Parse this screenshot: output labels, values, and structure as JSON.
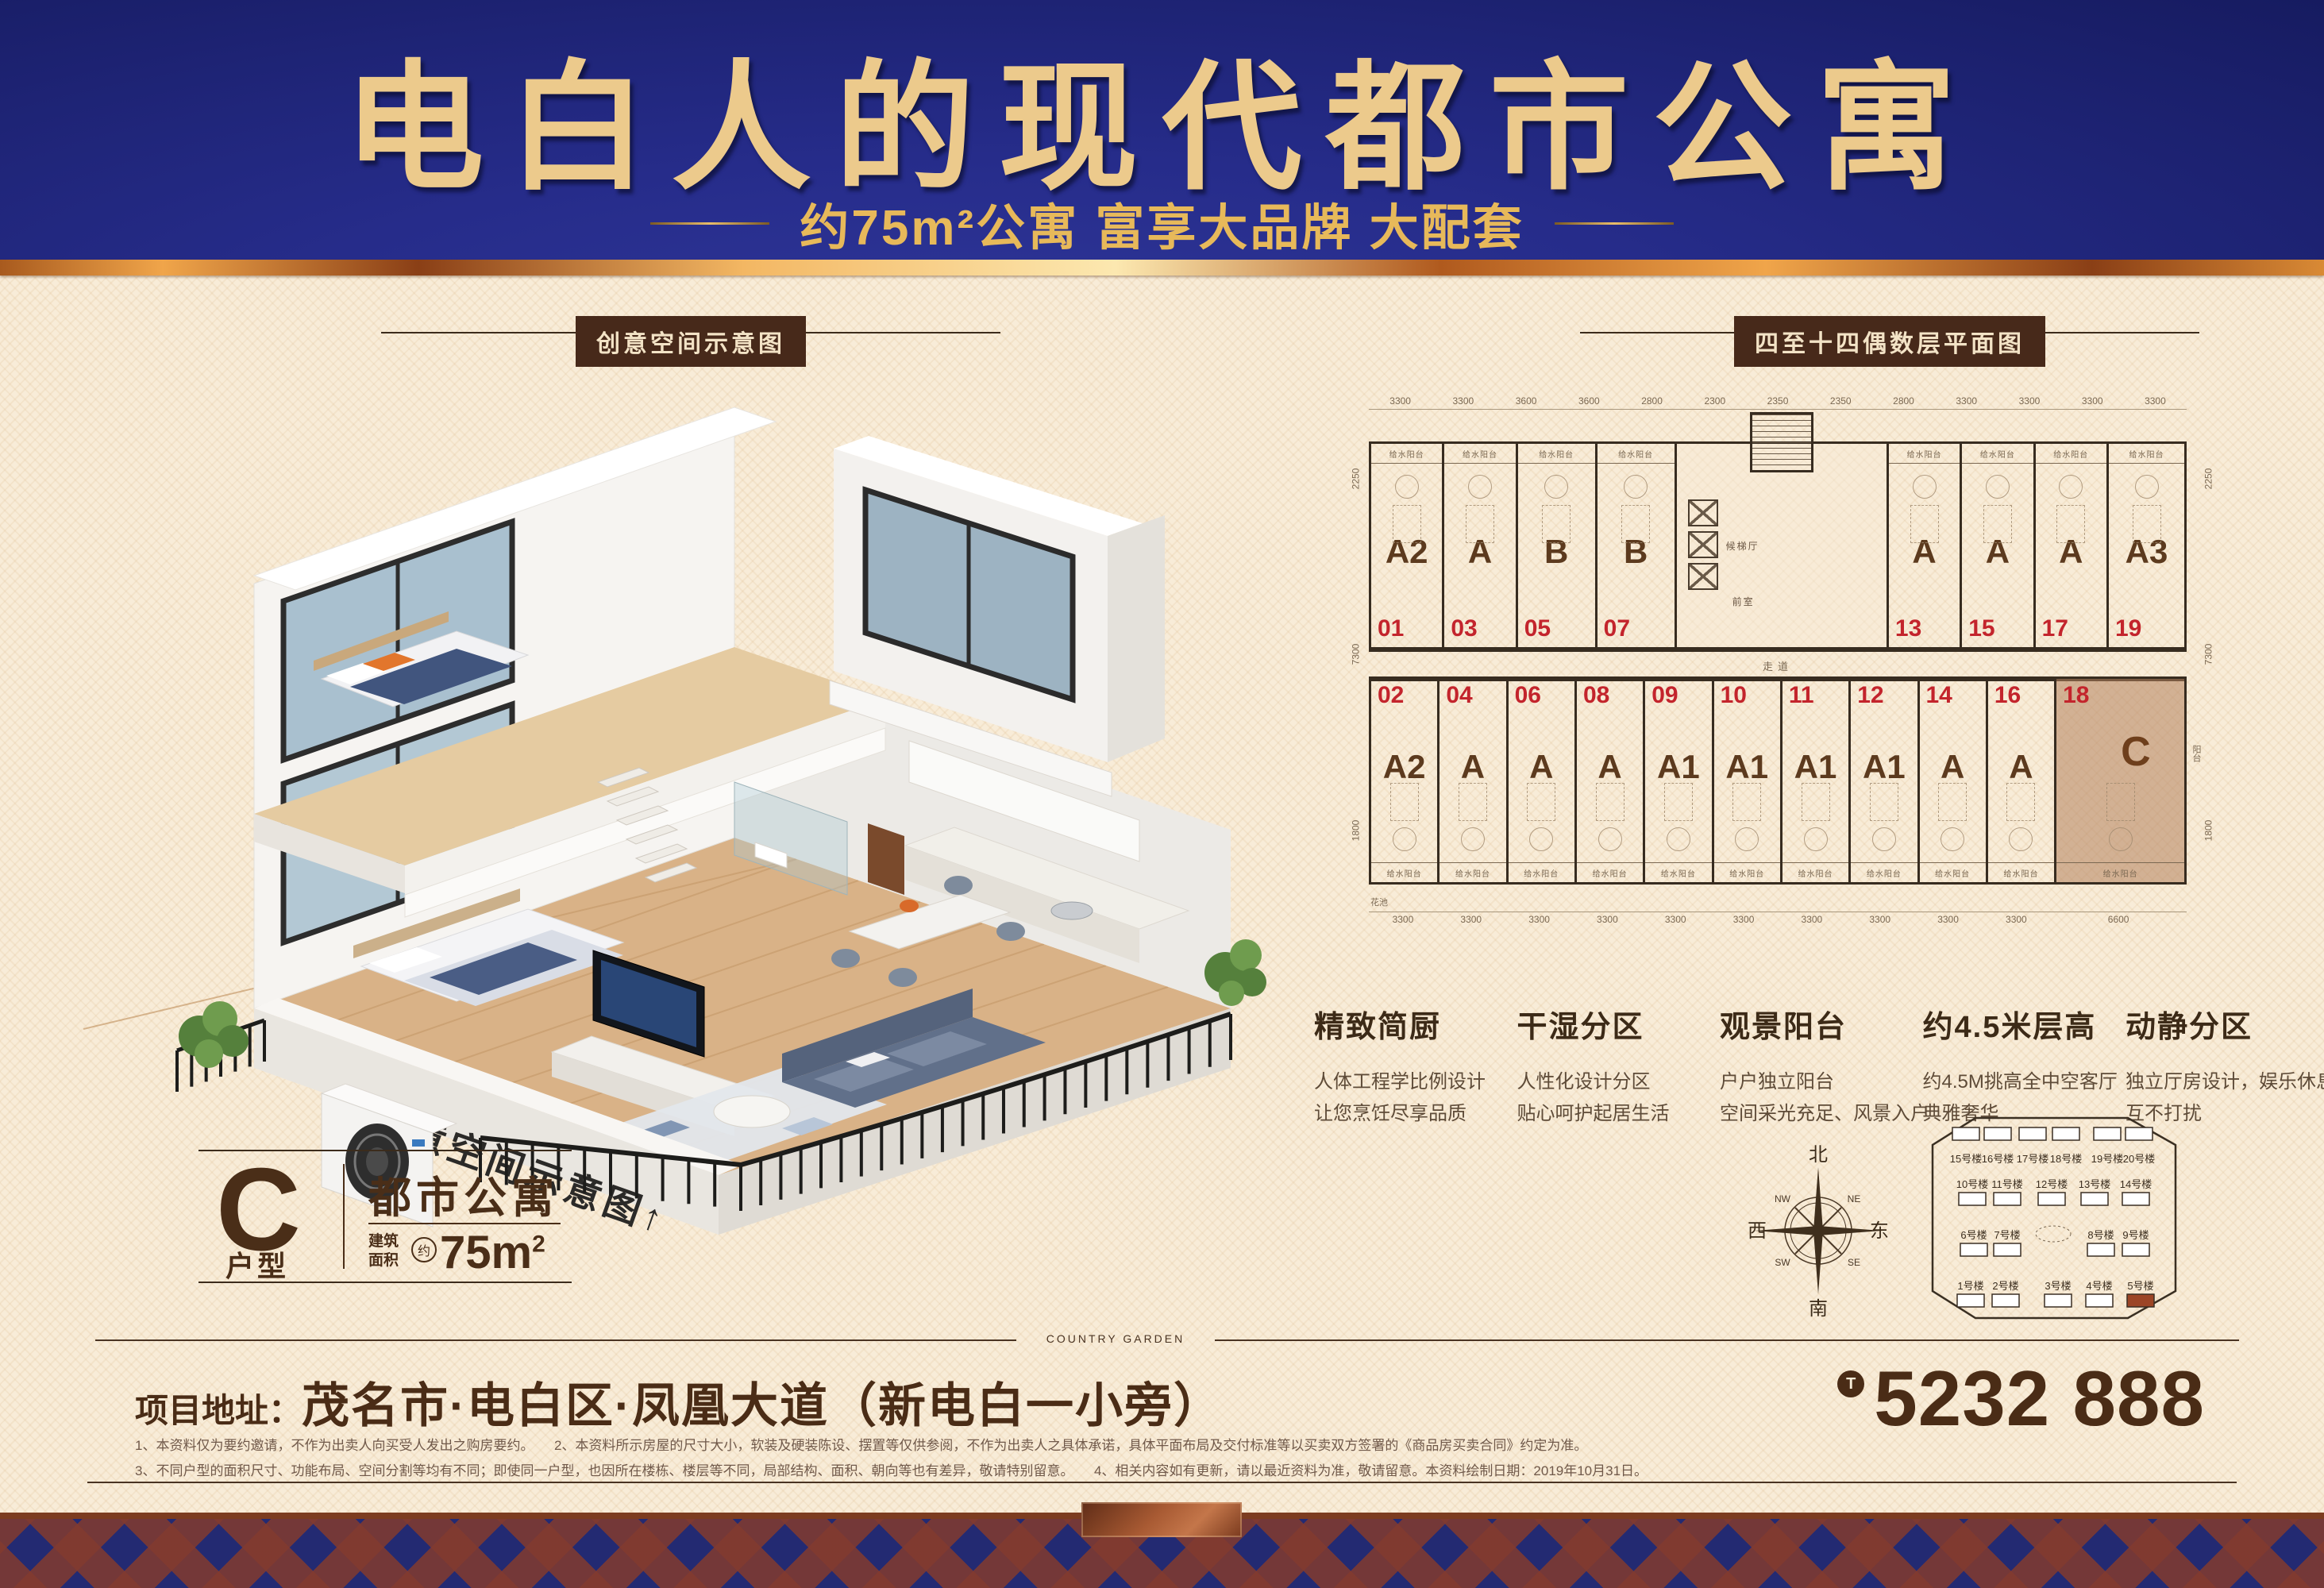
{
  "banner": {
    "title": "电白人的现代都市公寓",
    "subtitle": "约75m²公寓 富享大品牌 大配套"
  },
  "section_labels": {
    "render": "创意空间示意图",
    "plan": "四至十四偶数层平面图"
  },
  "render_overlay": {
    "text": "↑创意空间示意图↑"
  },
  "floorplan": {
    "dims_top": [
      "3300",
      "3300",
      "3600",
      "3600",
      "2800",
      "2300",
      "2350",
      "2350",
      "2800",
      "3300",
      "3300",
      "3300",
      "3300"
    ],
    "dims_bottom": [
      "3300",
      "3300",
      "3300",
      "3300",
      "3300",
      "3300",
      "3300",
      "3300",
      "3300",
      "3300",
      "6600"
    ],
    "dims_left": [
      "2250",
      "7300",
      "1800"
    ],
    "dims_right": [
      "2250",
      "7300",
      "1800"
    ],
    "balcony_label": "给水阳台",
    "corridor_label": "走道",
    "core": {
      "stair_label": "候梯厅",
      "lobby_label": "前室"
    },
    "extra_labels": {
      "planter": "花池",
      "side_balcony": "阳台"
    },
    "top_units": [
      {
        "type": "A2",
        "no": "01"
      },
      {
        "type": "A",
        "no": "03"
      },
      {
        "type": "B",
        "no": "05"
      },
      {
        "type": "B",
        "no": "07"
      },
      {
        "type": "A",
        "no": "13"
      },
      {
        "type": "A",
        "no": "15"
      },
      {
        "type": "A",
        "no": "17"
      },
      {
        "type": "A3",
        "no": "19"
      }
    ],
    "bottom_units": [
      {
        "type": "A2",
        "no": "02"
      },
      {
        "type": "A",
        "no": "04"
      },
      {
        "type": "A",
        "no": "06"
      },
      {
        "type": "A",
        "no": "08"
      },
      {
        "type": "A1",
        "no": "09"
      },
      {
        "type": "A1",
        "no": "10"
      },
      {
        "type": "A1",
        "no": "11"
      },
      {
        "type": "A1",
        "no": "12"
      },
      {
        "type": "A",
        "no": "14"
      },
      {
        "type": "A",
        "no": "16"
      },
      {
        "type": "C",
        "no": "18",
        "highlight": true
      }
    ]
  },
  "features": [
    {
      "title": "精致简厨",
      "lines": [
        "人体工程学比例设计",
        "让您烹饪尽享品质"
      ]
    },
    {
      "title": "干湿分区",
      "lines": [
        "人性化设计分区",
        "贴心呵护起居生活"
      ]
    },
    {
      "title": "观景阳台",
      "lines": [
        "户户独立阳台",
        "空间采光充足、风景入户"
      ]
    },
    {
      "title": "约4.5米层高",
      "lines": [
        "约4.5M挑高全中空客厅",
        "典雅奢华"
      ]
    },
    {
      "title": "动静分区",
      "lines": [
        "独立厅房设计，娱乐休息",
        "互不打扰"
      ]
    }
  ],
  "compass": {
    "n": "北",
    "s": "南",
    "e": "东",
    "w": "西",
    "ne": "NE",
    "nw": "NW",
    "se": "SE",
    "sw": "SW"
  },
  "siteplan": {
    "rows": [
      [
        "15号楼",
        "16号楼",
        "17号楼",
        "18号楼",
        "19号楼",
        "20号楼"
      ],
      [
        "10号楼",
        "11号楼",
        "12号楼",
        "13号楼",
        "14号楼"
      ],
      [
        "6号楼",
        "7号楼",
        "8号楼",
        "9号楼"
      ],
      [
        "1号楼",
        "2号楼",
        "3号楼",
        "4号楼",
        "5号楼"
      ]
    ],
    "highlight": "5号楼"
  },
  "unit_card": {
    "letter": "C",
    "letter_label": "户型",
    "name": "都市公寓",
    "area_prefix_1": "建筑",
    "area_prefix_2": "面积",
    "approx_badge": "约",
    "area_value": "75m",
    "area_sup": "2"
  },
  "brand_divider": "COUNTRY GARDEN",
  "footer": {
    "address_label": "项目地址：",
    "address": "茂名市·电白区·凤凰大道（新电白一小旁）",
    "phone_badge": "T",
    "phone": "5232 888",
    "disclaimer_line1": "1、本资料仅为要约邀请，不作为出卖人向买受人发出之购房要约。　　2、本资料所示房屋的尺寸大小，软装及硬装陈设、摆置等仅供参阅，不作为出卖人之具体承诺，具体平面布局及交付标准等以买卖双方签署的《商品房买卖合同》约定为准。",
    "disclaimer_line2": "3、不同户型的面积尺寸、功能布局、空间分割等均有不同；即使同一户型，也因所在楼栋、楼层等不同，局部结构、面积、朝向等也有差异，敬请特别留意。　　4、相关内容如有更新，请以最近资料为准，敬请留意。本资料绘制日期：2019年10月31日。"
  }
}
